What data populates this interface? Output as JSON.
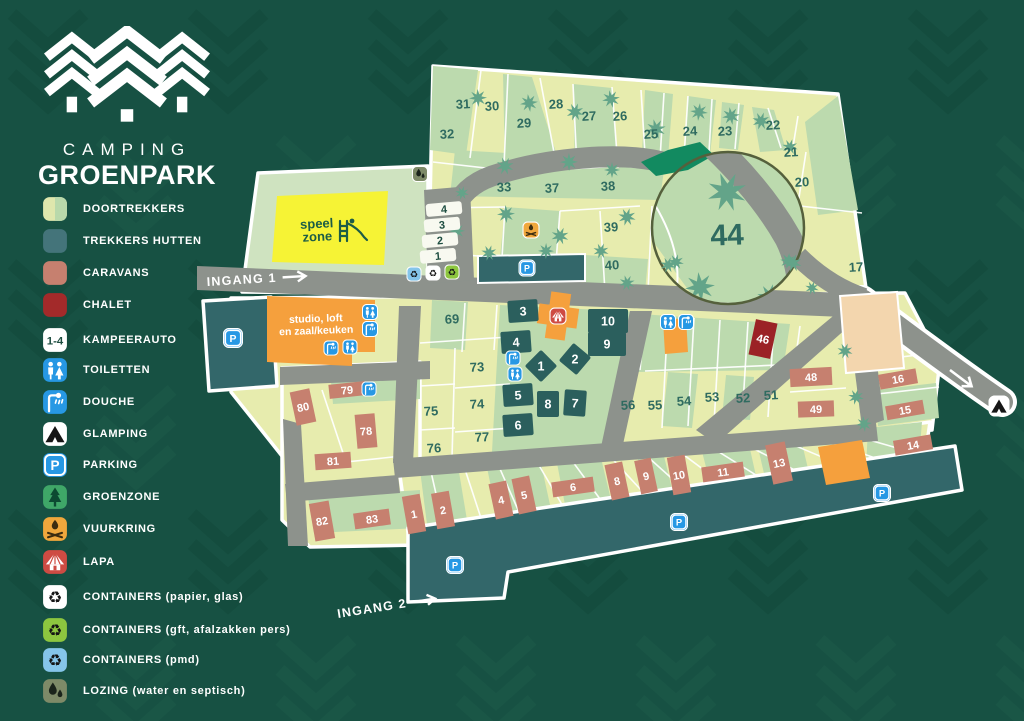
{
  "colors": {
    "bg": "#175143",
    "bg_pattern_dark": "#114839",
    "bg_pattern_light": "#1d5a49",
    "plot_yellow": "#e7ecae",
    "plot_green": "#bcdaae",
    "section_green": "#cfe3c0",
    "road": "#8d928c",
    "teal": "#33676a",
    "hut": "#2b5f5d",
    "caravan": "#c6806f",
    "chalet": "#9b2226",
    "number": "#2f6b60",
    "orange": "#f5a03d",
    "peach": "#f3d6ae",
    "speel_yellow": "#f6f335",
    "speel_text": "#1c5c46",
    "blue_icon": "#2798e4",
    "green_icon": "#3fa768",
    "amber_icon": "#f0a73c",
    "red_icon": "#ce4b43",
    "lime_icon": "#8dc63f",
    "lightblue_icon": "#85c5ea",
    "olive_icon": "#7e8a68",
    "emerald": "#128a60",
    "tree": "#63a489",
    "circle_stroke": "#55603c",
    "white": "#ffffff"
  },
  "logo": {
    "line1": "CAMPING",
    "line2": "GROENPARK"
  },
  "legend": {
    "items": [
      {
        "id": "doortrekkers",
        "label": "DOORTREKKERS",
        "icon": "swatch-split"
      },
      {
        "id": "trekkers-hutten",
        "label": "TREKKERS HUTTEN",
        "icon": "swatch",
        "color": "#44747a"
      },
      {
        "id": "caravans",
        "label": "CARAVANS",
        "icon": "swatch",
        "color": "#c6806f"
      },
      {
        "id": "chalet",
        "label": "CHALET",
        "icon": "swatch",
        "color": "#a32a2a"
      },
      {
        "id": "kampeerauto",
        "label": "KAMPEERAUTO",
        "icon": "box-1-4",
        "text": "1-4"
      },
      {
        "id": "toiletten",
        "label": "TOILETTEN",
        "icon": "toiletten"
      },
      {
        "id": "douche",
        "label": "DOUCHE",
        "icon": "douche"
      },
      {
        "id": "glamping",
        "label": "GLAMPING",
        "icon": "glamping"
      },
      {
        "id": "parking",
        "label": "PARKING",
        "icon": "parking"
      },
      {
        "id": "groenzone",
        "label": "GROENZONE",
        "icon": "groenzone"
      },
      {
        "id": "vuurkring",
        "label": "VUURKRING",
        "icon": "vuurkring"
      },
      {
        "id": "lapa",
        "label": "LAPA",
        "icon": "lapa"
      },
      {
        "id": "containers-papier-glas",
        "label": "CONTAINERS (papier, glas)",
        "icon": "recycle-papier"
      },
      {
        "id": "containers-gft",
        "label": "CONTAINERS (gft, afalzakken pers)",
        "icon": "recycle-gft"
      },
      {
        "id": "containers-pmd",
        "label": "CONTAINERS (pmd)",
        "icon": "recycle-pmd"
      },
      {
        "id": "lozing",
        "label": "LOZING (water en septisch)",
        "icon": "lozing"
      }
    ]
  },
  "map": {
    "entrance1": "INGANG 1",
    "entrance2": "INGANG 2",
    "speelzone": {
      "line1": "speel",
      "line2": "zone"
    },
    "studio": {
      "line1": "studio, loft",
      "line2": "en zaal/keuken"
    },
    "magnifier_number": "44",
    "kampeerauto_spots": [
      "4",
      "3",
      "2",
      "1"
    ],
    "plot_numbers": [
      {
        "n": "31",
        "x": 463,
        "y": 104
      },
      {
        "n": "30",
        "x": 492,
        "y": 106
      },
      {
        "n": "29",
        "x": 524,
        "y": 123
      },
      {
        "n": "28",
        "x": 556,
        "y": 104
      },
      {
        "n": "27",
        "x": 589,
        "y": 116
      },
      {
        "n": "26",
        "x": 620,
        "y": 116
      },
      {
        "n": "25",
        "x": 651,
        "y": 134
      },
      {
        "n": "24",
        "x": 690,
        "y": 131
      },
      {
        "n": "23",
        "x": 725,
        "y": 131
      },
      {
        "n": "22",
        "x": 773,
        "y": 125
      },
      {
        "n": "21",
        "x": 791,
        "y": 152
      },
      {
        "n": "20",
        "x": 802,
        "y": 182
      },
      {
        "n": "17",
        "x": 856,
        "y": 267
      },
      {
        "n": "32",
        "x": 447,
        "y": 134
      },
      {
        "n": "33",
        "x": 504,
        "y": 187
      },
      {
        "n": "37",
        "x": 552,
        "y": 188
      },
      {
        "n": "38",
        "x": 608,
        "y": 186
      },
      {
        "n": "39",
        "x": 611,
        "y": 227
      },
      {
        "n": "40",
        "x": 612,
        "y": 265
      },
      {
        "n": "69",
        "x": 452,
        "y": 319
      },
      {
        "n": "73",
        "x": 477,
        "y": 367
      },
      {
        "n": "74",
        "x": 477,
        "y": 404
      },
      {
        "n": "75",
        "x": 431,
        "y": 411
      },
      {
        "n": "76",
        "x": 434,
        "y": 448
      },
      {
        "n": "77",
        "x": 482,
        "y": 437
      },
      {
        "n": "51",
        "x": 771,
        "y": 395
      },
      {
        "n": "52",
        "x": 743,
        "y": 398
      },
      {
        "n": "53",
        "x": 712,
        "y": 397
      },
      {
        "n": "54",
        "x": 684,
        "y": 401
      },
      {
        "n": "55",
        "x": 655,
        "y": 405
      },
      {
        "n": "56",
        "x": 628,
        "y": 405
      }
    ],
    "huts": [
      {
        "n": "3",
        "x": 523,
        "y": 311,
        "w": 30,
        "h": 22,
        "r": -4
      },
      {
        "n": "4",
        "x": 516,
        "y": 342,
        "w": 30,
        "h": 22,
        "r": -4
      },
      {
        "n": "5",
        "x": 518,
        "y": 395,
        "w": 30,
        "h": 22,
        "r": -4
      },
      {
        "n": "6",
        "x": 518,
        "y": 425,
        "w": 30,
        "h": 22,
        "r": -4
      },
      {
        "n": "8",
        "x": 548,
        "y": 404,
        "w": 22,
        "h": 26,
        "r": 0
      },
      {
        "n": "7",
        "x": 575,
        "y": 403,
        "w": 22,
        "h": 26,
        "r": 4
      },
      {
        "n": "9",
        "x": 607,
        "y": 344,
        "w": 38,
        "h": 24,
        "r": 0
      },
      {
        "n": "10",
        "x": 608,
        "y": 321,
        "w": 40,
        "h": 24,
        "r": 0
      },
      {
        "n": "1",
        "x": 541,
        "y": 366,
        "w": 23,
        "h": 23,
        "r": 45
      },
      {
        "n": "2",
        "x": 575,
        "y": 359,
        "w": 23,
        "h": 23,
        "r": 40
      }
    ],
    "caravans": [
      {
        "n": "79",
        "x": 347,
        "y": 390,
        "w": 36,
        "h": 14,
        "r": -6
      },
      {
        "n": "80",
        "x": 303,
        "y": 407,
        "w": 20,
        "h": 34,
        "r": -12
      },
      {
        "n": "78",
        "x": 366,
        "y": 431,
        "w": 20,
        "h": 34,
        "r": -5
      },
      {
        "n": "81",
        "x": 333,
        "y": 461,
        "w": 36,
        "h": 16,
        "r": -4
      },
      {
        "n": "82",
        "x": 322,
        "y": 521,
        "w": 20,
        "h": 38,
        "r": -10
      },
      {
        "n": "83",
        "x": 372,
        "y": 519,
        "w": 36,
        "h": 16,
        "r": -8
      },
      {
        "n": "1",
        "x": 414,
        "y": 514,
        "w": 18,
        "h": 38,
        "r": -10
      },
      {
        "n": "2",
        "x": 443,
        "y": 510,
        "w": 18,
        "h": 36,
        "r": -10
      },
      {
        "n": "4",
        "x": 501,
        "y": 500,
        "w": 18,
        "h": 36,
        "r": -12
      },
      {
        "n": "5",
        "x": 524,
        "y": 495,
        "w": 18,
        "h": 36,
        "r": -12
      },
      {
        "n": "6",
        "x": 573,
        "y": 487,
        "w": 42,
        "h": 15,
        "r": -8
      },
      {
        "n": "8",
        "x": 617,
        "y": 481,
        "w": 18,
        "h": 36,
        "r": -12
      },
      {
        "n": "9",
        "x": 646,
        "y": 476,
        "w": 17,
        "h": 34,
        "r": -12
      },
      {
        "n": "10",
        "x": 679,
        "y": 475,
        "w": 18,
        "h": 38,
        "r": -10
      },
      {
        "n": "11",
        "x": 723,
        "y": 472,
        "w": 42,
        "h": 15,
        "r": -8
      },
      {
        "n": "13",
        "x": 779,
        "y": 463,
        "w": 20,
        "h": 40,
        "r": -12
      },
      {
        "n": "14",
        "x": 913,
        "y": 445,
        "w": 38,
        "h": 15,
        "r": -10
      },
      {
        "n": "15",
        "x": 905,
        "y": 410,
        "w": 38,
        "h": 14,
        "r": -10
      },
      {
        "n": "16",
        "x": 898,
        "y": 379,
        "w": 38,
        "h": 15,
        "r": -10
      },
      {
        "n": "48",
        "x": 811,
        "y": 377,
        "w": 42,
        "h": 18,
        "r": -3
      },
      {
        "n": "49",
        "x": 816,
        "y": 409,
        "w": 36,
        "h": 16,
        "r": -2
      }
    ],
    "chalet": {
      "n": "46",
      "x": 763,
      "y": 339,
      "w": 22,
      "h": 36,
      "r": 12
    },
    "icons": [
      {
        "type": "lozing",
        "x": 420,
        "y": 174,
        "s": 16
      },
      {
        "type": "recycle-pmd",
        "x": 414,
        "y": 274,
        "s": 15
      },
      {
        "type": "recycle-papier",
        "x": 433,
        "y": 273,
        "s": 15
      },
      {
        "type": "recycle-gft",
        "x": 452,
        "y": 272,
        "s": 15
      },
      {
        "type": "parking",
        "x": 233,
        "y": 338,
        "s": 20
      },
      {
        "type": "parking",
        "x": 527,
        "y": 268,
        "s": 17
      },
      {
        "type": "parking",
        "x": 455,
        "y": 565,
        "s": 18
      },
      {
        "type": "parking",
        "x": 679,
        "y": 522,
        "s": 18
      },
      {
        "type": "parking",
        "x": 882,
        "y": 493,
        "s": 18
      },
      {
        "type": "toiletten",
        "x": 370,
        "y": 312,
        "s": 16
      },
      {
        "type": "douche",
        "x": 370,
        "y": 329,
        "s": 16
      },
      {
        "type": "douche",
        "x": 331,
        "y": 348,
        "s": 15
      },
      {
        "type": "toiletten",
        "x": 350,
        "y": 347,
        "s": 15
      },
      {
        "type": "douche",
        "x": 513,
        "y": 358,
        "s": 15
      },
      {
        "type": "toiletten",
        "x": 515,
        "y": 374,
        "s": 15
      },
      {
        "type": "toiletten",
        "x": 668,
        "y": 322,
        "s": 16
      },
      {
        "type": "douche",
        "x": 686,
        "y": 322,
        "s": 16
      },
      {
        "type": "douche",
        "x": 369,
        "y": 389,
        "s": 15
      },
      {
        "type": "vuurkring",
        "x": 531,
        "y": 230,
        "s": 17
      },
      {
        "type": "lapa",
        "x": 558,
        "y": 316,
        "s": 17
      },
      {
        "type": "glamping",
        "x": 999,
        "y": 406,
        "s": 21
      }
    ],
    "trees": [
      [
        478,
        98,
        9
      ],
      [
        529,
        103,
        9
      ],
      [
        575,
        112,
        9
      ],
      [
        611,
        99,
        9
      ],
      [
        656,
        129,
        10
      ],
      [
        699,
        112,
        9
      ],
      [
        731,
        116,
        9
      ],
      [
        761,
        121,
        9
      ],
      [
        790,
        147,
        8
      ],
      [
        505,
        166,
        9
      ],
      [
        569,
        162,
        9
      ],
      [
        612,
        170,
        8
      ],
      [
        462,
        193,
        7
      ],
      [
        506,
        214,
        9
      ],
      [
        457,
        231,
        8
      ],
      [
        560,
        236,
        9
      ],
      [
        627,
        217,
        9
      ],
      [
        489,
        253,
        8
      ],
      [
        546,
        251,
        8
      ],
      [
        601,
        251,
        8
      ],
      [
        627,
        283,
        8
      ],
      [
        668,
        265,
        8
      ],
      [
        793,
        263,
        9
      ],
      [
        812,
        288,
        7
      ],
      [
        845,
        351,
        8
      ],
      [
        856,
        397,
        8
      ],
      [
        864,
        424,
        8
      ]
    ],
    "magnifier_trees": [
      [
        727,
        192,
        20
      ],
      [
        700,
        287,
        15
      ],
      [
        770,
        297,
        13
      ],
      [
        676,
        262,
        8
      ],
      [
        788,
        261,
        8
      ]
    ]
  }
}
